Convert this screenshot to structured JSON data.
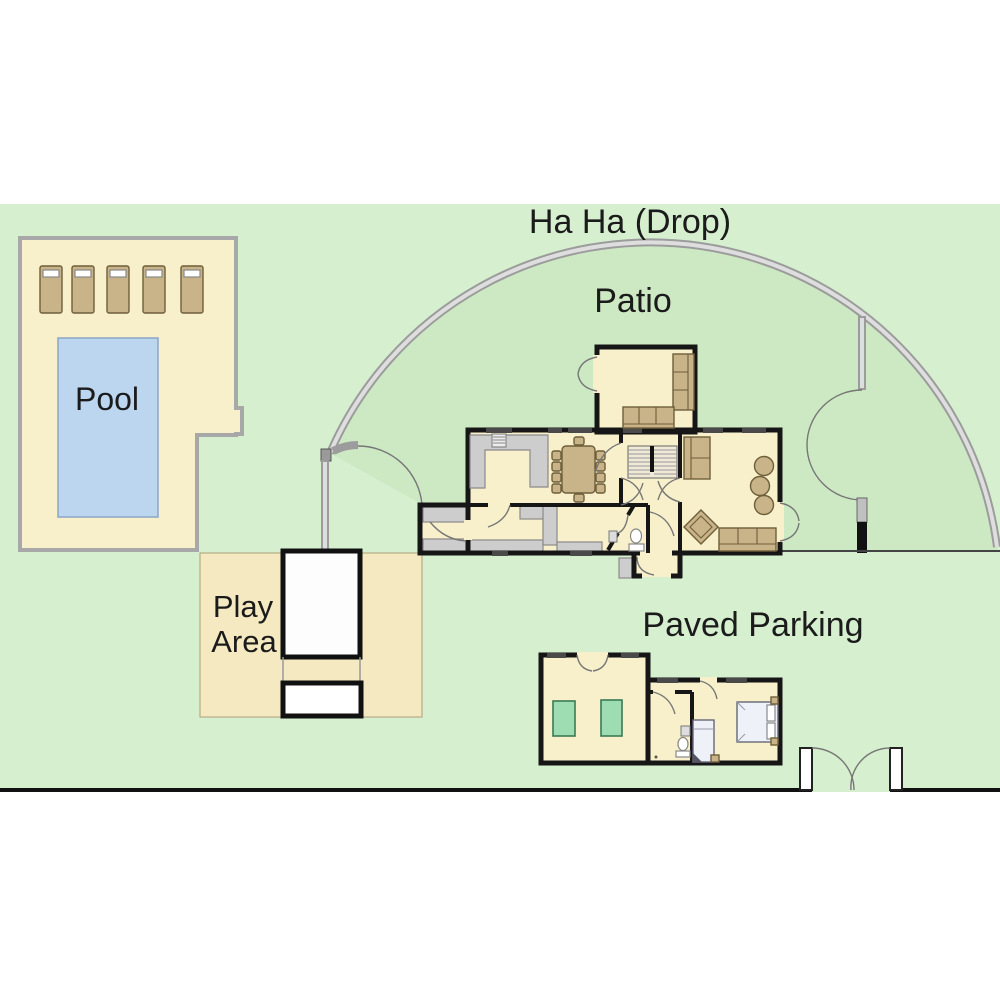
{
  "plan": {
    "title": "Ha Ha (Drop)",
    "areas": {
      "patio": {
        "label": "Patio"
      },
      "pool": {
        "label": "Pool",
        "lounger_count": 5
      },
      "play_area": {
        "line1": "Play",
        "line2": "Area",
        "equipment_count": 2
      },
      "paved_parking": {
        "label": "Paved Parking"
      }
    },
    "annexe": {
      "green_table_count": 2,
      "bed_count": 2
    }
  },
  "colors": {
    "grass": "#d6efcf",
    "patio-grass": "#cde9c3",
    "floor": "#f7f0ca",
    "pool-water": "#bcd6f0",
    "furniture": "#c9b489",
    "counter": "#cdcdcd",
    "wall": "#161616",
    "boundary": "#9c9c9c",
    "boundary-light": "#dedede",
    "annexe-table": "#9edcb2",
    "ink": "#1b1b1b"
  }
}
